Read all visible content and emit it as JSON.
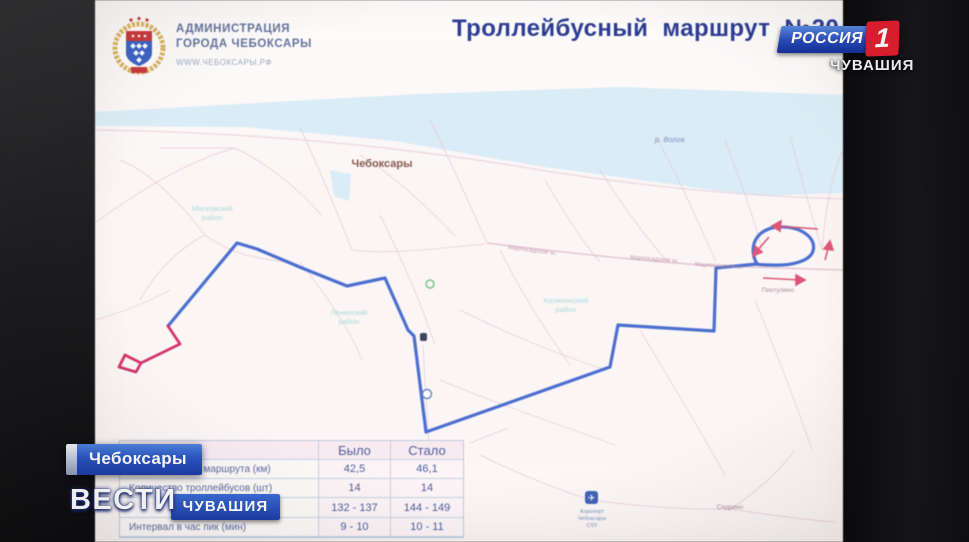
{
  "channel": {
    "name": "РОССИЯ",
    "number": "1",
    "region": "ЧУВАШИЯ",
    "brand_blue": "#2749b8",
    "brand_red": "#e11f2f"
  },
  "lower_thirds": {
    "location_badge": "Чебоксары",
    "vesti": "ВЕСТИ",
    "vesti_region": "ЧУВАШИЯ"
  },
  "slide": {
    "org_line1": "АДМИНИСТРАЦИЯ",
    "org_line2": "ГОРОДА ЧЕБОКСАРЫ",
    "org_url": "WWW.ЧЕБОКСАРЫ.РФ",
    "title": "Троллейбусный маршрут №20"
  },
  "map": {
    "city": "Чебоксары",
    "river": "р. Волга",
    "districts": [
      {
        "l1": "Московский",
        "l2": "район"
      },
      {
        "l1": "Ленинский",
        "l2": "район"
      },
      {
        "l1": "Калининский",
        "l2": "район"
      }
    ],
    "roads": [
      "Марпосадское ш.",
      "Марпосадское ш.",
      "Марпосадское ш."
    ],
    "places": [
      "Пихтулино",
      "Сядрино"
    ],
    "airport": {
      "l1": "Аэропорт",
      "l2": "Чебоксары",
      "l3": "CSY"
    },
    "route_color_existing": "#4a6fd4",
    "route_color_new": "#d6336c"
  },
  "table": {
    "col_was": "Было",
    "col_now": "Стало",
    "rows": [
      {
        "label": "Протяженность маршрута (км)",
        "was": "42,5",
        "now": "46,1"
      },
      {
        "label": "Количество троллейбусов (шт)",
        "was": "14",
        "now": "14"
      },
      {
        "label": "",
        "was": "132 - 137",
        "now": "144 - 149"
      },
      {
        "label": "Интервал в час пик (мин)",
        "was": "9 - 10",
        "now": "10 - 11"
      }
    ]
  }
}
